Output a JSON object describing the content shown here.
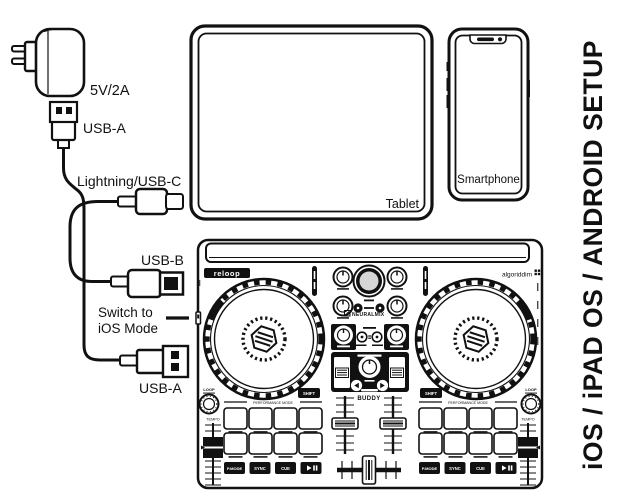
{
  "title": {
    "vertical_label": "iOS / iPAD OS / ANDROID SETUP"
  },
  "cables": {
    "power_rating": "5V/2A",
    "usb_a": "USB-A",
    "lightning_usb_c": "Lightning/USB-C",
    "usb_b": "USB-B",
    "switch_note_line1": "Switch to",
    "switch_note_line2": "iOS Mode"
  },
  "devices": {
    "tablet": "Tablet",
    "smartphone": "Smartphone"
  },
  "controller": {
    "brand": "reloop",
    "partner_logo": "algoriddim",
    "model": "BUDDY",
    "neural_mix": "NEURALMIX",
    "performance_mode": "PERFORMANCE MODE",
    "shift": "SHIFT",
    "loop": "LOOP",
    "tempo": "TEMPO",
    "transport": {
      "pad_mode": "P.MODE",
      "sync": "SYNC",
      "cue": "CUE"
    }
  },
  "colors": {
    "ink": "#111111",
    "background": "#ffffff"
  }
}
